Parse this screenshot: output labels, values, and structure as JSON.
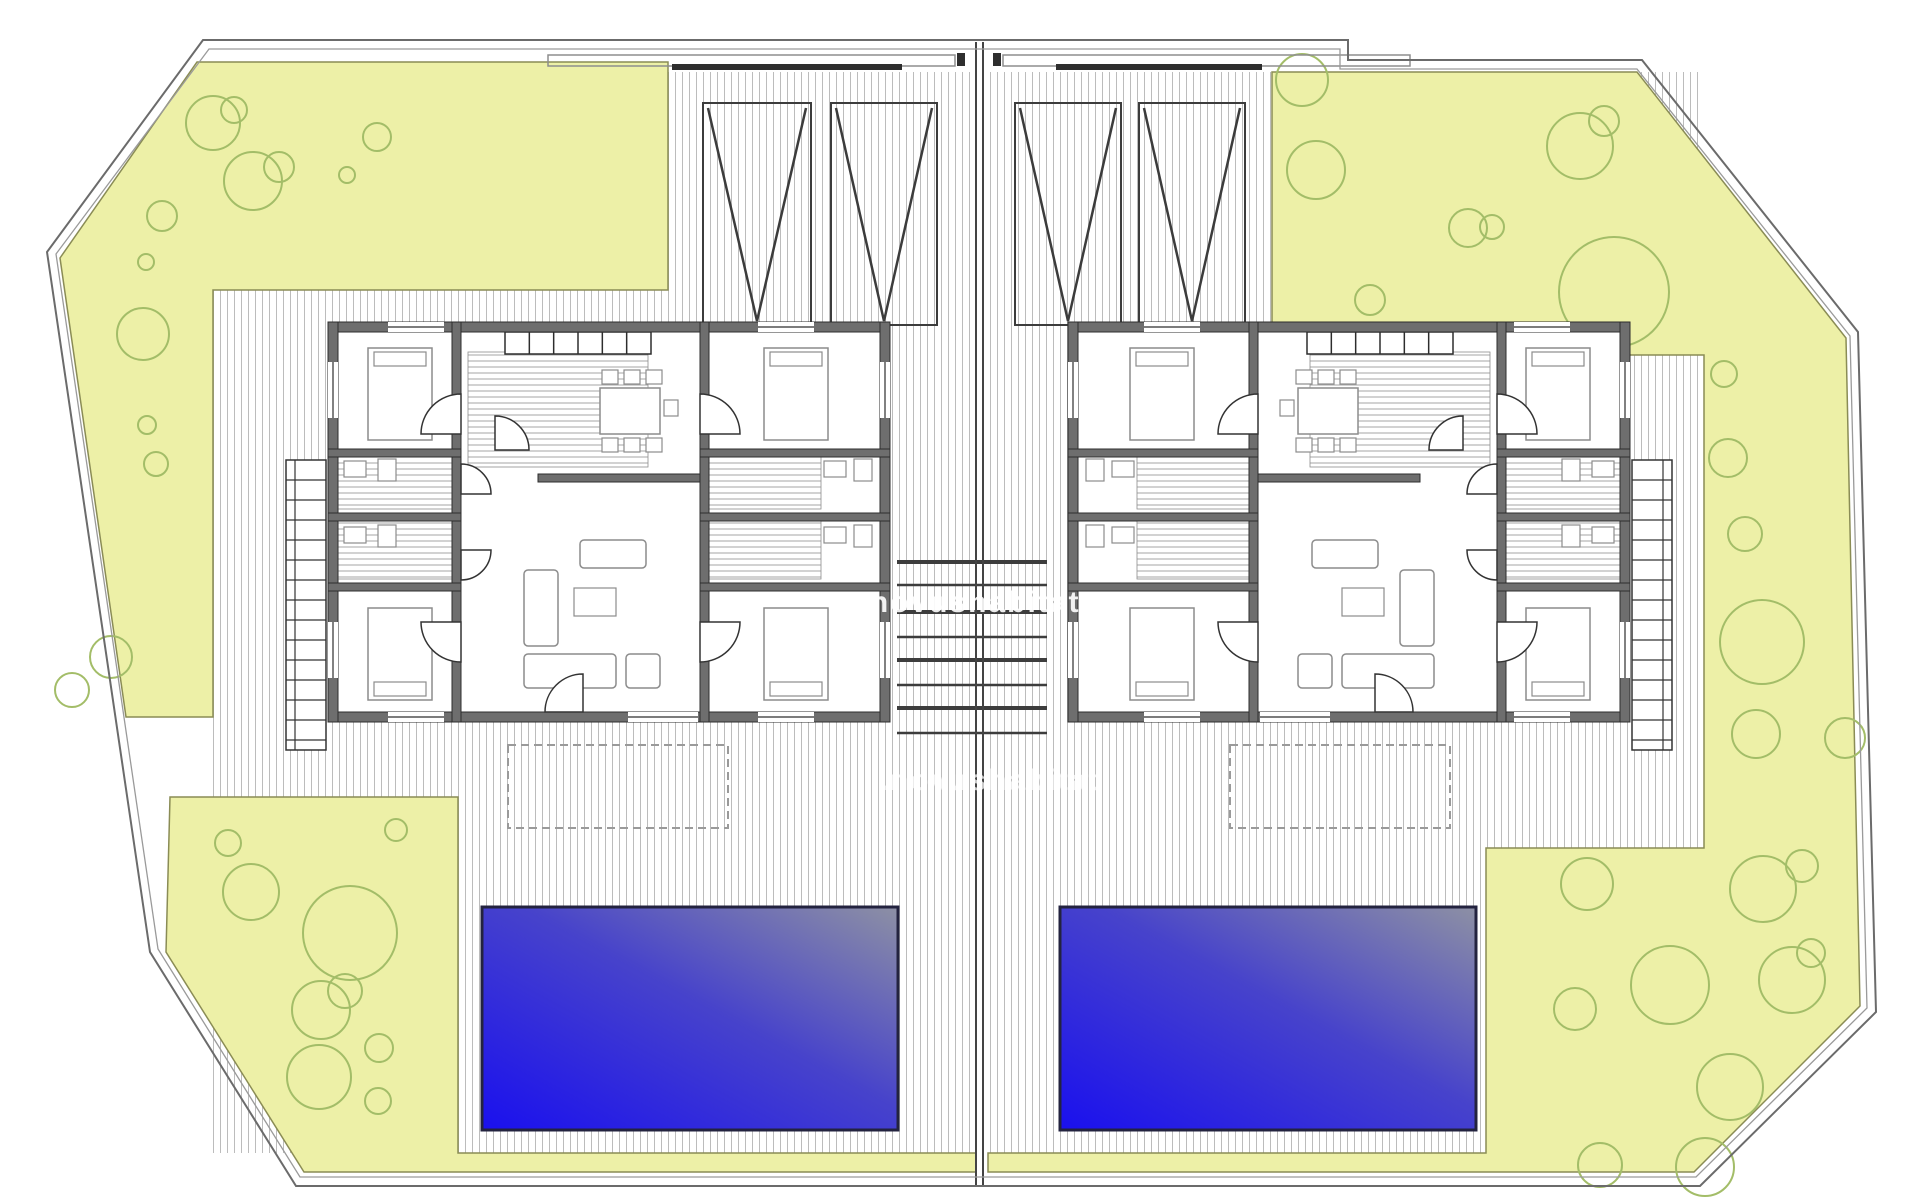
{
  "watermark": {
    "text": ".novushabitat",
    "color": "rgba(255,255,255,0.9)",
    "color_faint": "rgba(255,255,255,0.72)"
  },
  "palette": {
    "paper": "#ffffff",
    "garden": "#edf0a7",
    "garden_border": "#8a8c55",
    "tree": "#a3bd68",
    "hatch": "#bcbcbc",
    "hatch_room": "#a6a6a6",
    "wall": "#6e6e6e",
    "wall_edge": "#2d2d2d",
    "thin_line": "#8d8d8d",
    "boundary": "#6b6b6b",
    "boundary_inner": "#9a9a9a",
    "divider": "#444444",
    "pool_deep": "#1a10ee",
    "pool_mid": "#4743cb",
    "pool_shallow": "#8d90a4",
    "pool_border": "#23233f",
    "furniture_line": "#8c8c8c",
    "steps": "#3d3d3d",
    "fence": "#2e2e2e",
    "dashed": "#9a9a9a",
    "stall": "#3c3c3c"
  },
  "site": {
    "boundary_outer": "203,40 1348,40 1348,60 1642,60 1858,332 1876,1012 1700,1186 296,1186 150,952 47,252",
    "boundary_inner": "209,49 1340,49 1340,69 1637,69 1850,336 1867,1008 1696,1177 300,1177 158,949 56,254",
    "terrace": {
      "x": 213,
      "y": 72,
      "w": 1491,
      "h": 1081
    },
    "divider": {
      "x1": 976,
      "x2": 983,
      "y_top": 42,
      "y_bottom": 1186
    }
  },
  "gardens": [
    {
      "name": "garden-top-left",
      "points": "197,62 668,62 668,290 213,290 213,717 126,717 60,258"
    },
    {
      "name": "garden-right",
      "points": "1272,72 1637,72 1846,338 1860,1006 1694,1172 988,1172 988,1153 1486,1153 1486,848 1704,848 1704,355 1272,355"
    },
    {
      "name": "garden-bottom-left",
      "points": "170,797 458,797 458,1153 976,1153 976,1172 304,1172 166,952"
    }
  ],
  "trees": [
    [
      213,
      123,
      27
    ],
    [
      234,
      110,
      13
    ],
    [
      377,
      137,
      14
    ],
    [
      347,
      175,
      8
    ],
    [
      253,
      181,
      29
    ],
    [
      279,
      167,
      15
    ],
    [
      162,
      216,
      15
    ],
    [
      146,
      262,
      8
    ],
    [
      143,
      334,
      26
    ],
    [
      147,
      425,
      9
    ],
    [
      156,
      464,
      12
    ],
    [
      111,
      657,
      21
    ],
    [
      72,
      690,
      17
    ],
    [
      1302,
      80,
      26
    ],
    [
      1316,
      170,
      29
    ],
    [
      1580,
      146,
      33
    ],
    [
      1604,
      121,
      15
    ],
    [
      1468,
      228,
      19
    ],
    [
      1492,
      227,
      12
    ],
    [
      1370,
      300,
      15
    ],
    [
      1614,
      292,
      55
    ],
    [
      1724,
      374,
      13
    ],
    [
      1728,
      458,
      19
    ],
    [
      1745,
      534,
      17
    ],
    [
      1762,
      642,
      42
    ],
    [
      1756,
      734,
      24
    ],
    [
      1845,
      738,
      20
    ],
    [
      1587,
      884,
      26
    ],
    [
      1763,
      889,
      33
    ],
    [
      1802,
      866,
      16
    ],
    [
      1575,
      1009,
      21
    ],
    [
      1670,
      985,
      39
    ],
    [
      1792,
      980,
      33
    ],
    [
      1811,
      953,
      14
    ],
    [
      1730,
      1087,
      33
    ],
    [
      1705,
      1167,
      29
    ],
    [
      1600,
      1165,
      22
    ],
    [
      396,
      830,
      11
    ],
    [
      228,
      843,
      13
    ],
    [
      251,
      892,
      28
    ],
    [
      350,
      933,
      47
    ],
    [
      321,
      1010,
      29
    ],
    [
      345,
      991,
      17
    ],
    [
      379,
      1048,
      14
    ],
    [
      319,
      1077,
      32
    ],
    [
      378,
      1101,
      13
    ]
  ],
  "pools": [
    {
      "x": 482,
      "y": 907,
      "w": 416,
      "h": 223
    },
    {
      "x": 1060,
      "y": 907,
      "w": 416,
      "h": 223
    }
  ],
  "parking": {
    "stalls": [
      [
        703,
        103,
        108,
        222
      ],
      [
        831,
        103,
        106,
        222
      ],
      [
        1015,
        103,
        106,
        222
      ],
      [
        1139,
        103,
        106,
        222
      ]
    ],
    "rails": [
      [
        548,
        55,
        407,
        11
      ],
      [
        1003,
        55,
        407,
        11
      ]
    ],
    "dark_lines": [
      [
        672,
        64,
        230,
        6
      ],
      [
        1056,
        64,
        206,
        6
      ]
    ],
    "posts": [
      [
        957,
        53,
        8,
        13
      ],
      [
        993,
        53,
        8,
        13
      ]
    ]
  },
  "central_steps": {
    "x1": 897,
    "x2": 1047,
    "lines": [
      562,
      585,
      612,
      637,
      660,
      685,
      708,
      733
    ]
  },
  "pergolas": [
    [
      508,
      745,
      220,
      83
    ],
    [
      1230,
      745,
      220,
      83
    ]
  ],
  "stairs": [
    {
      "x": 286,
      "y": 460,
      "w": 40,
      "h": 290,
      "rail": "left"
    },
    {
      "x": 1632,
      "y": 460,
      "w": 40,
      "h": 290,
      "rail": "right"
    }
  ],
  "house": {
    "w": 562,
    "h": 400,
    "walls": [
      [
        0,
        0,
        562,
        10
      ],
      [
        0,
        390,
        562,
        10
      ],
      [
        0,
        0,
        10,
        400
      ],
      [
        552,
        0,
        10,
        400
      ],
      [
        124,
        0,
        9,
        400
      ],
      [
        372,
        0,
        9,
        400
      ],
      [
        0,
        127,
        133,
        8
      ],
      [
        0,
        191,
        133,
        8
      ],
      [
        0,
        261,
        133,
        8
      ],
      [
        372,
        127,
        190,
        8
      ],
      [
        372,
        191,
        190,
        8
      ],
      [
        372,
        261,
        190,
        8
      ],
      [
        210,
        152,
        162,
        8
      ]
    ],
    "windows": [
      {
        "side": "top",
        "pos": 60,
        "len": 56
      },
      {
        "side": "top",
        "pos": 430,
        "len": 56
      },
      {
        "side": "bottom",
        "pos": 60,
        "len": 56
      },
      {
        "side": "bottom",
        "pos": 300,
        "len": 70
      },
      {
        "side": "bottom",
        "pos": 430,
        "len": 56
      },
      {
        "side": "left",
        "pos": 40,
        "len": 56
      },
      {
        "side": "left",
        "pos": 300,
        "len": 56
      },
      {
        "side": "right",
        "pos": 40,
        "len": 56
      },
      {
        "side": "right",
        "pos": 300,
        "len": 56
      }
    ],
    "kitchen_hatch": [
      140,
      30,
      180,
      115
    ],
    "bath_hatches": [
      [
        10,
        135,
        114,
        52
      ],
      [
        10,
        199,
        114,
        58
      ],
      [
        381,
        135,
        112,
        52
      ],
      [
        381,
        199,
        112,
        58
      ]
    ],
    "kitchen_cells": {
      "x": 177,
      "y": 10,
      "w": 146,
      "h": 22,
      "n": 6
    },
    "beds": [
      {
        "x": 40,
        "y": 26,
        "w": 64,
        "h": 92,
        "pillow": "top"
      },
      {
        "x": 40,
        "y": 286,
        "w": 64,
        "h": 92,
        "pillow": "bottom"
      },
      {
        "x": 436,
        "y": 26,
        "w": 64,
        "h": 92,
        "pillow": "top"
      },
      {
        "x": 436,
        "y": 286,
        "w": 64,
        "h": 92,
        "pillow": "bottom"
      }
    ],
    "table": [
      272,
      66,
      60,
      46
    ],
    "chairs": [
      [
        274,
        48,
        16,
        14
      ],
      [
        296,
        48,
        16,
        14
      ],
      [
        318,
        48,
        16,
        14
      ],
      [
        274,
        116,
        16,
        14
      ],
      [
        296,
        116,
        16,
        14
      ],
      [
        318,
        116,
        16,
        14
      ],
      [
        336,
        78,
        14,
        16
      ]
    ],
    "sofas": [
      [
        196,
        248,
        34,
        76
      ],
      [
        196,
        332,
        92,
        34
      ],
      [
        298,
        332,
        34,
        34
      ],
      [
        252,
        218,
        66,
        28
      ]
    ],
    "sofa_table": [
      246,
      266,
      42,
      28
    ],
    "fixtures": [
      [
        16,
        139,
        22,
        16
      ],
      [
        50,
        137,
        18,
        22
      ],
      [
        16,
        205,
        22,
        16
      ],
      [
        50,
        203,
        18,
        22
      ],
      [
        496,
        139,
        22,
        16
      ],
      [
        526,
        137,
        18,
        22
      ],
      [
        496,
        205,
        22,
        16
      ],
      [
        526,
        203,
        18,
        22
      ]
    ],
    "doors": [
      [
        133,
        112,
        40,
        180,
        270
      ],
      [
        133,
        300,
        40,
        90,
        180
      ],
      [
        167,
        128,
        34,
        270,
        360
      ],
      [
        372,
        112,
        40,
        270,
        360
      ],
      [
        372,
        300,
        40,
        0,
        90
      ],
      [
        255,
        390,
        38,
        180,
        270
      ],
      [
        133,
        172,
        30,
        270,
        360
      ],
      [
        133,
        228,
        30,
        0,
        90
      ]
    ]
  },
  "houses": [
    {
      "x": 328,
      "y": 322,
      "mirrored": false
    },
    {
      "x": 1630,
      "y": 322,
      "mirrored": true
    }
  ]
}
